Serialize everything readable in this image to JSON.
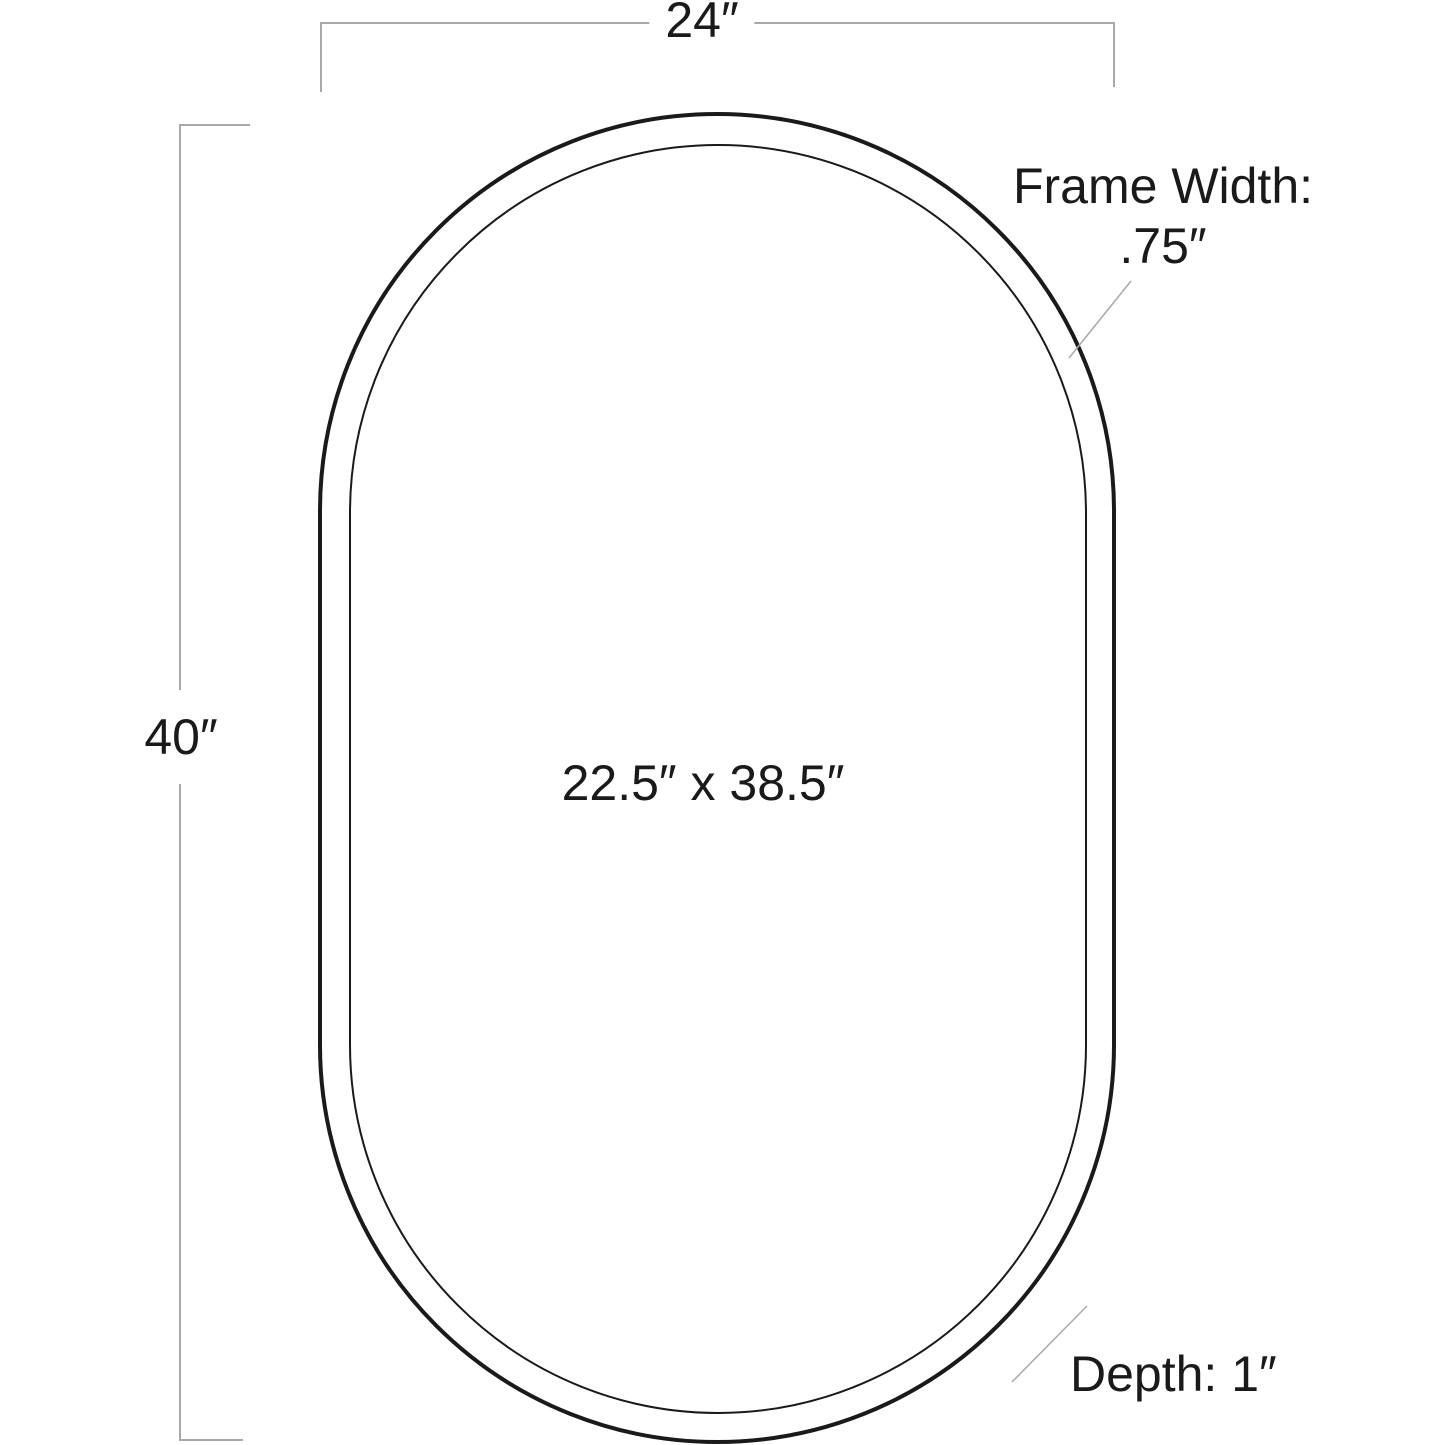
{
  "colors": {
    "background": "#ffffff",
    "frame-line": "#1a1a1a",
    "dimension-line": "#a8a8a8",
    "text": "#1a1a1a"
  },
  "diagram": {
    "type": "product-dimension-diagram",
    "shape": "capsule-oval-mirror",
    "labels": {
      "overall_width": "24″",
      "overall_height": "40″",
      "interior_size": "22.5″ x 38.5″",
      "frame_width_line1": "Frame Width:",
      "frame_width_line2": ".75″",
      "depth": "Depth: 1″"
    }
  }
}
